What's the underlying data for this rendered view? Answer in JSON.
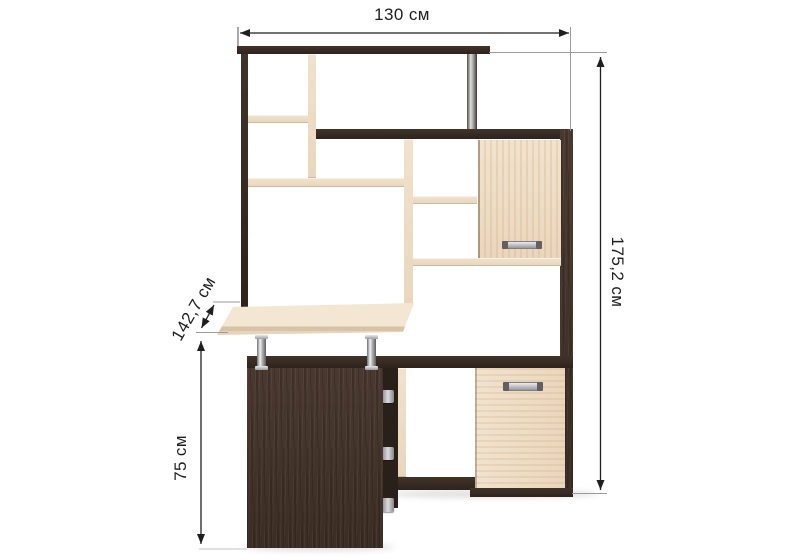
{
  "diagram": {
    "kind": "furniture dimension diagram",
    "subject": "corner computer desk with shelving hutch",
    "unit": "см",
    "labels": {
      "width": "130 см",
      "height": "175,2 см",
      "diagonal_depth": "142,7 см",
      "desk_height": "75 см"
    },
    "values": {
      "width_cm": 130,
      "height_cm": 175.2,
      "diagonal_depth_cm": 142.7,
      "desk_height_cm": 75
    },
    "colors": {
      "dark_wood": "#3b2d24",
      "dark_wood_deep": "#2e241d",
      "light_wood": "#e9d6bd",
      "chrome": "#a9a9ad",
      "dimension_line": "#1f1f1f",
      "extension_line": "#9a9a9a",
      "background": "#ffffff"
    }
  }
}
